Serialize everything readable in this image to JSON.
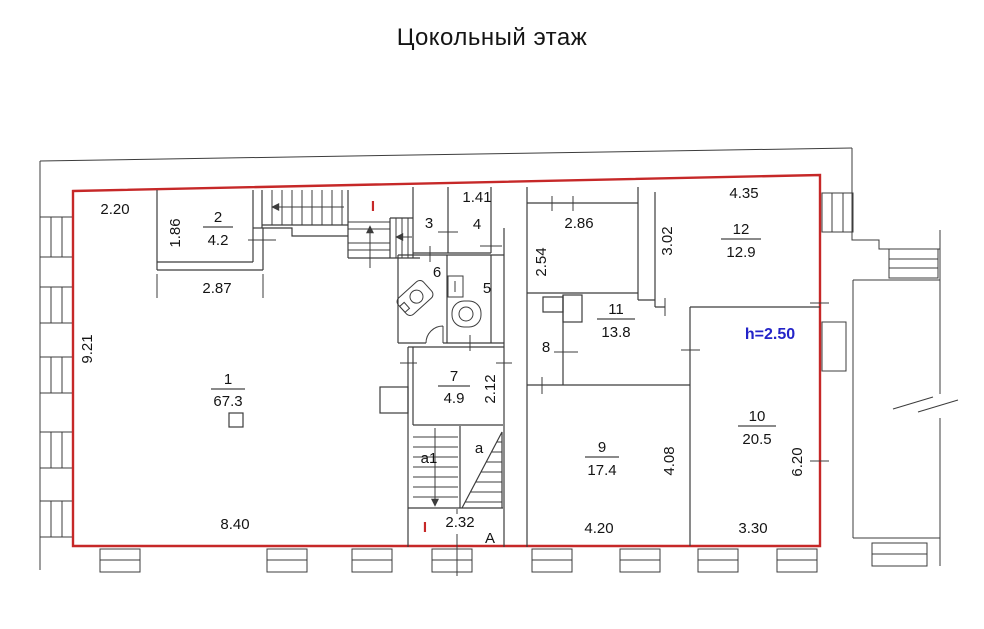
{
  "title": "Цокольный этаж",
  "colors": {
    "boundary": "#c62828",
    "height_note": "#2323c8",
    "lines": "#3c3c3c",
    "text": "#141414"
  },
  "rooms": [
    {
      "number": "1",
      "area": "67.3"
    },
    {
      "number": "2",
      "area": "4.2"
    },
    {
      "number": "3"
    },
    {
      "number": "4"
    },
    {
      "number": "5"
    },
    {
      "number": "6"
    },
    {
      "number": "7",
      "area": "4.9"
    },
    {
      "number": "8"
    },
    {
      "number": "9",
      "area": "17.4"
    },
    {
      "number": "10",
      "area": "20.5"
    },
    {
      "number": "11",
      "area": "13.8"
    },
    {
      "number": "12",
      "area": "12.9"
    }
  ],
  "dimensions": {
    "room1_top_offset": "2.20",
    "room2_height": "1.86",
    "room2_width": "2.87",
    "room1_height": "9.21",
    "room1_width": "8.40",
    "room4_width": "1.41",
    "hall_width": "2.86",
    "hall_height": "2.54",
    "room12_width": "4.35",
    "room12_height": "3.02",
    "room7_height": "2.12",
    "stairwell_width": "2.32",
    "room9_width": "4.20",
    "room9_height": "4.08",
    "room10_width": "3.30",
    "room10_height": "6.20"
  },
  "markers": {
    "entry_top": "I",
    "entry_bottom": "I",
    "axis": "А"
  },
  "stairs": {
    "flight_inner": "a1",
    "flight_winder": "a"
  },
  "notes": {
    "ceiling_height": "h=2.50"
  }
}
